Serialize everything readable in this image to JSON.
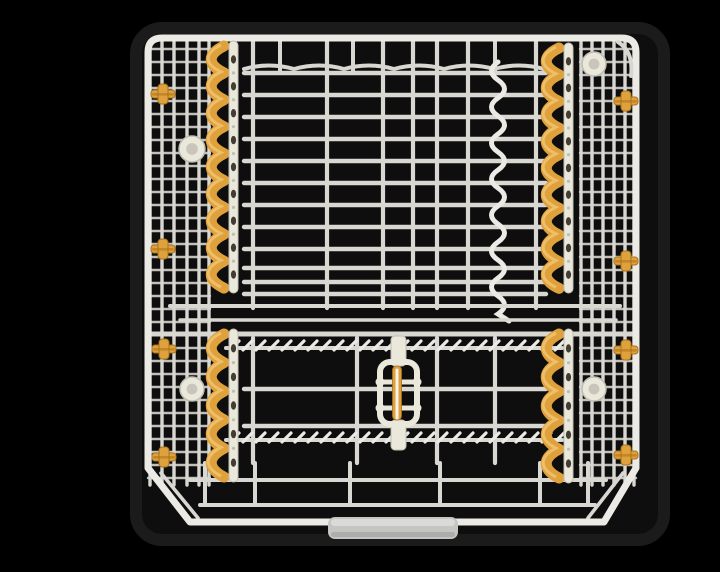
{
  "meta": {
    "type": "product-photo",
    "subject": "dishwasher-rack-top-view",
    "alt": "Top-down product photo of a dishwasher upper rack: ivory wire grid basket with amber wave-shaped plate holders, amber side adjuster clips, a central plastic latch with amber strip, chamfered front corners and a gray front handle, on a black background"
  },
  "colors": {
    "bg": "#000000",
    "tub": "#0e0e0e",
    "tub_edge": "#1b1b1b",
    "wire": "#d9d7d1",
    "wire_bright": "#eceae4",
    "wire_dim": "#c2c0ba",
    "amber": "#dfa13c",
    "amber_dark": "#a8731a",
    "amber_light": "#f3c878",
    "plastic": "#eae7db",
    "plastic_edge": "#c0bdb1",
    "hole": "#413d33",
    "handle": "#c5c5c3",
    "handle_hi": "#dcdcda",
    "handle_lo": "#a6a6a4"
  },
  "scene": {
    "canvas": {
      "w": 720,
      "h": 540
    },
    "tub": {
      "x": 96,
      "y": 12,
      "w": 528,
      "h": 512,
      "rx": 26
    },
    "frame": {
      "path": "M108,452 L108,36 Q108,22 122,22 L582,22 Q596,22 596,36 L596,452 M108,452 L150,506 L564,506 L596,452",
      "width": 7
    },
    "corner_guide": "M578,26 q16,10 13,34",
    "inner_chamfers": [
      [
        121,
        457,
        158,
        502
      ],
      [
        583,
        457,
        548,
        502
      ]
    ],
    "panels": {
      "left": {
        "x1": 108,
        "x2": 170,
        "verticals": [
          110,
          122,
          134,
          147,
          159,
          169
        ],
        "rung_y1": 33,
        "rung_y2": 464,
        "rung_step": 13
      },
      "right": {
        "x1": 540,
        "x2": 596,
        "verticals": [
          541,
          552,
          563,
          574,
          585,
          594
        ],
        "rung_y1": 33,
        "rung_y2": 464,
        "rung_step": 13
      }
    },
    "top_field": {
      "x1": 204,
      "x2": 506,
      "back_y": 53,
      "h_ys": [
        57,
        79,
        101,
        123,
        145,
        167,
        189,
        211,
        233,
        252,
        266,
        278
      ],
      "v_xs": [
        213,
        287,
        343,
        373,
        397,
        428,
        496
      ],
      "v_y1": 24,
      "v_y2": 292,
      "short_v_xs": [
        240,
        313,
        455
      ],
      "short_v_y2": 55,
      "wavy": {
        "x": 458,
        "y1": 46,
        "y2": 304,
        "amp": 13,
        "half": 18
      }
    },
    "mid_rails": [
      {
        "y": 290,
        "x1": 130,
        "x2": 580,
        "w": 4
      },
      {
        "y": 304,
        "x1": 140,
        "x2": 576,
        "w": 3.4
      },
      {
        "y": 318,
        "x1": 108,
        "x2": 596,
        "w": 5
      }
    ],
    "bottom_field": {
      "x1": 204,
      "x2": 506,
      "h_ys": [
        373,
        410
      ],
      "v_xs": [
        213,
        317,
        397,
        455
      ],
      "v_y1": 322,
      "v_y2": 447,
      "tine_rows": [
        {
          "y": 332,
          "x1": 186,
          "x2": 522
        },
        {
          "y": 424,
          "x1": 186,
          "x2": 522
        }
      ],
      "tine_step": 13
    },
    "bottom_structure": {
      "loop_xs": [
        165,
        215,
        310,
        400,
        500,
        548
      ],
      "loop_y1": 447,
      "loop_y2": 489,
      "rail_y": 489,
      "rail_x1": 160,
      "rail_x2": 555,
      "low_wire": {
        "y": 464,
        "x1": 150,
        "x2": 566
      }
    },
    "plate_strips": [
      {
        "cx": 184,
        "y1": 30,
        "y2": 272,
        "bumps": 9
      },
      {
        "cx": 519,
        "y1": 32,
        "y2": 272,
        "bumps": 9
      },
      {
        "cx": 184,
        "y1": 318,
        "y2": 461,
        "bumps": 5
      },
      {
        "cx": 519,
        "y1": 318,
        "y2": 462,
        "bumps": 5
      }
    ],
    "clips": [
      {
        "x": 123,
        "y": 78
      },
      {
        "x": 123,
        "y": 233
      },
      {
        "x": 124,
        "y": 333
      },
      {
        "x": 124,
        "y": 441
      },
      {
        "x": 586,
        "y": 85
      },
      {
        "x": 586,
        "y": 245
      },
      {
        "x": 586,
        "y": 334
      },
      {
        "x": 586,
        "y": 439
      }
    ],
    "rollers": [
      {
        "x": 152,
        "y": 133,
        "r": 13
      },
      {
        "x": 152,
        "y": 373,
        "r": 12
      },
      {
        "x": 554,
        "y": 48,
        "r": 12
      },
      {
        "x": 554,
        "y": 373,
        "r": 12
      }
    ],
    "latch": {
      "x": 340,
      "y": 346,
      "w": 37,
      "h": 62,
      "bar1_y": 366,
      "bar2_y": 392,
      "tab_x": 351,
      "top_tab_y": 320,
      "bot_tab_y": 404,
      "strip_x": 352.5,
      "strip_y": 350,
      "strip_h": 54
    },
    "handle": {
      "x": 288,
      "y": 501,
      "w": 130,
      "h": 22,
      "rx": 7
    }
  }
}
